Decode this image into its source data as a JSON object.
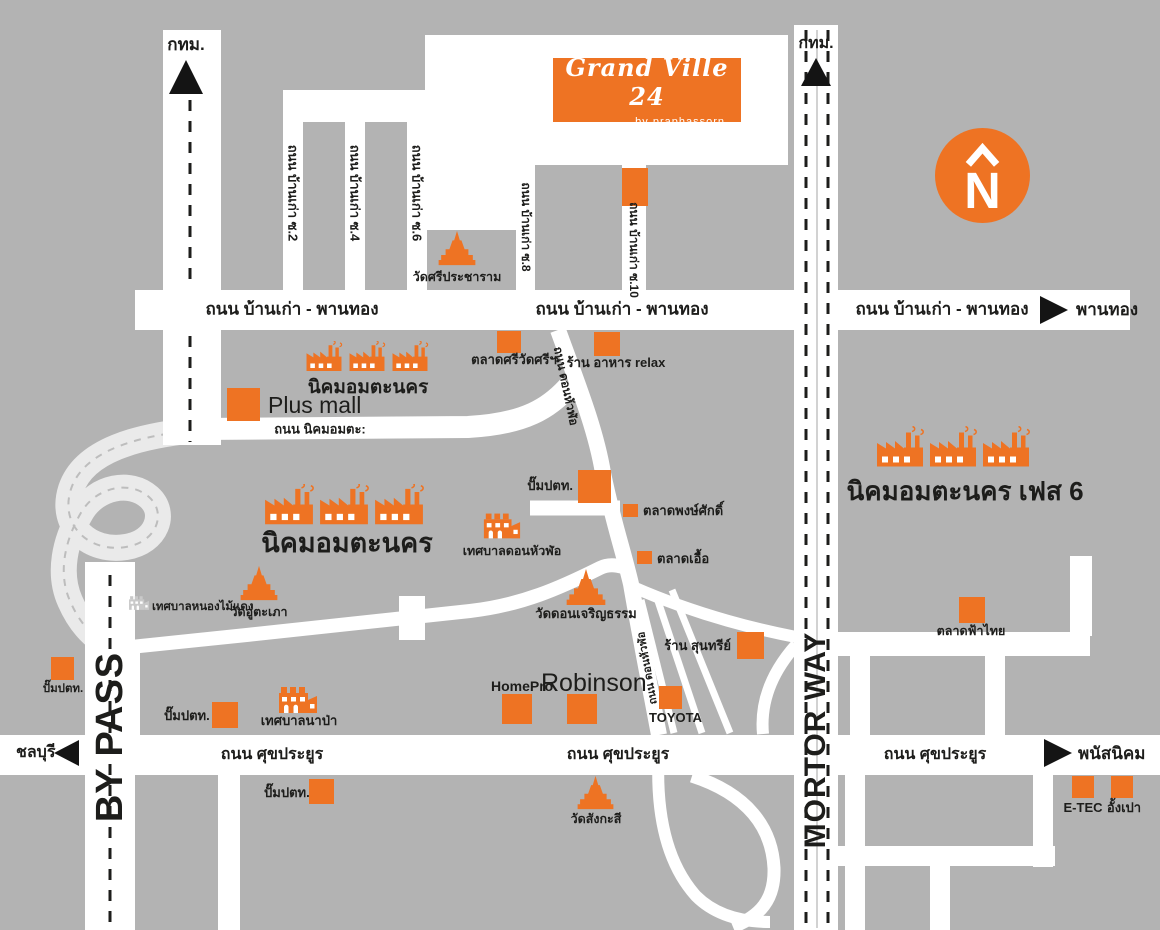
{
  "canvas": {
    "width": 1160,
    "height": 930
  },
  "colors": {
    "background": "#b3b3b3",
    "road": "#ffffff",
    "accent": "#ee7323",
    "ink": "#1d1d1b",
    "interchange": "#eaeaea"
  },
  "logo": {
    "title": "Grand Ville 24",
    "subtitle": "by  praphassorn"
  },
  "compass": {
    "letter": "N"
  },
  "directions": {
    "bkk": "กทม.",
    "phanthong": "พานทอง",
    "chonburi": "ชลบุรี",
    "phanat_nikhom": "พนัสนิคม"
  },
  "roads": {
    "ban_kao_phanthong": "ถนน บ้านเก่า - พานทอง",
    "sukprayoon": "ถนน ศุขประยูร",
    "nikhom_amata": "ถนน นิคมอมตะ:",
    "ban_kao_soi2": "ถนน บ้านเก่า ซ.2",
    "ban_kao_soi4": "ถนน บ้านเก่า ซ.4",
    "ban_kao_soi6": "ถนน บ้านเก่า ซ.6",
    "ban_kao_soi8": "ถนน บ้านเก่า ซ.8",
    "ban_kao_soi10": "ถนน บ้านเก่า ซ.10",
    "don_hua_lo": "ถนน ดอนหัวฬ่อ",
    "bypass": "BY PASS",
    "motorway": "MORTOR WAY"
  },
  "places": {
    "amata_nakorn": "นิคมอมตะนคร",
    "amata_phase6": "นิคมอมตะนคร เฟส 6",
    "plus_mall": "Plus mall",
    "wat_sri_pracharam": "วัดศรีประชาราม",
    "talad_sri_wat_sri": "ตลาดศรีวัดศรีฯ",
    "relax_restaurant": "ร้าน อาหาร relax",
    "ptt": "ปั๊มปตท.",
    "talad_pongsak": "ตลาดพงษ์ศักดิ์",
    "talad_uea": "ตลาดเอื้อ",
    "thesaban_don_hua_lo": "เทศบาลดอนหัวฬ่อ",
    "thesaban_nong_mai_daeng": "เทศบาลหนองไม้แดง",
    "wat_u_taphao": "วัดอู่ตะเภา",
    "wat_don_charoen_tham": "วัดดอนเจริญธรรม",
    "ran_suntaree": "ร้าน สุนทรีย์",
    "thesaban_napa": "เทศบาลนาป่า",
    "homepro": "HomePro",
    "robinson": "Robinson",
    "toyota": "TOYOTA",
    "wat_sangkasi": "วัดสังกะสี",
    "talad_fa_thai": "ตลาดฟ้าไทย",
    "etec": "E-TEC",
    "angpao": "อั้งเปา"
  }
}
